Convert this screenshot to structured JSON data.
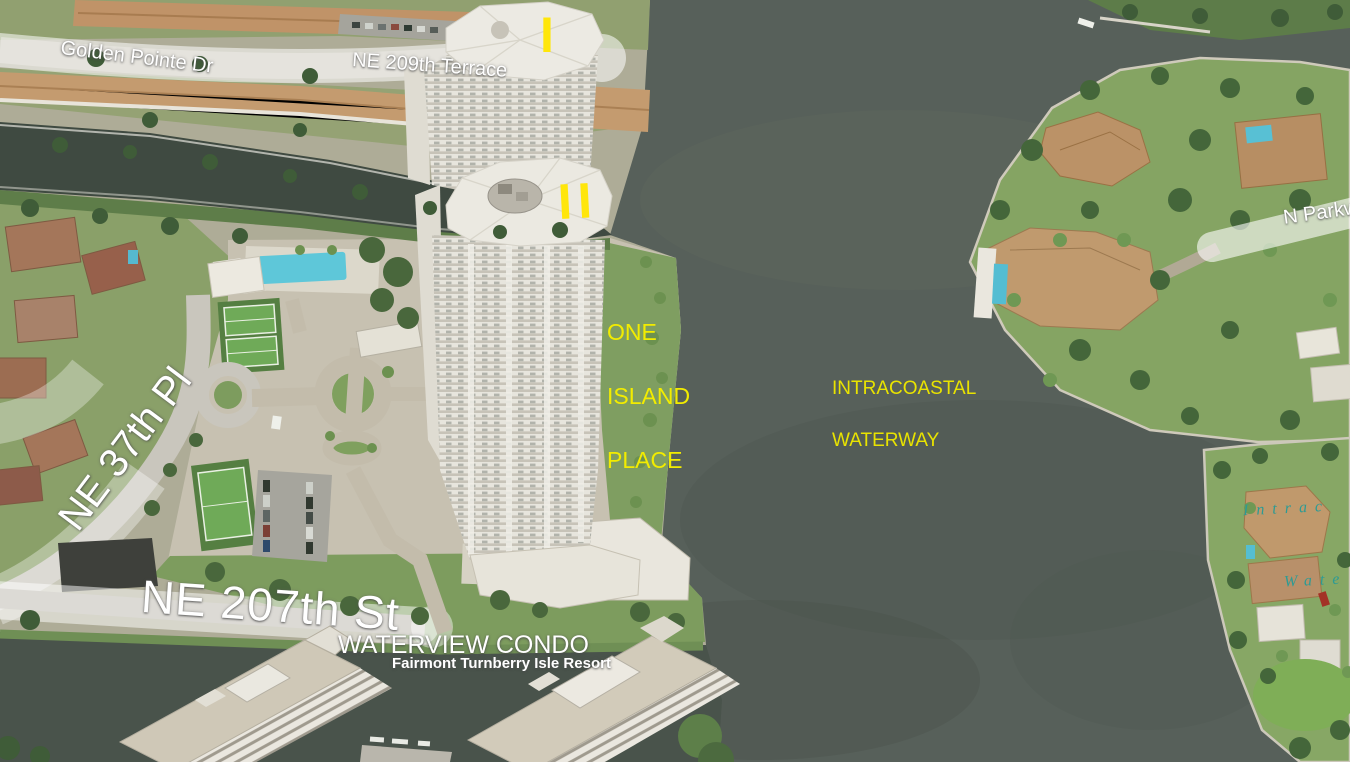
{
  "map": {
    "view": "aerial-birds-eye",
    "street_labels": {
      "golden_pointe": "Golden Pointe Dr",
      "ne_209th_terrace": "NE 209th Terrace",
      "n_parkway": "N Parkw",
      "ne_37th_pl": "NE 37th Pl",
      "ne_207th_st": "NE 207th St"
    },
    "place_labels": {
      "one_island": {
        "line1": "ONE",
        "line2": "ISLAND",
        "line3": "PLACE"
      },
      "intracoastal": {
        "line1": "INTRACOASTAL",
        "line2": "WATERWAY"
      },
      "waterview_condo": "WATERVIEW CONDO",
      "fairmont": "Fairmont Turnberry Isle Resort",
      "tower1_marker": "I",
      "tower2_marker": "II",
      "water_script_1": "Intrac",
      "water_script_2": "Wate"
    },
    "colors": {
      "water_main": "#57605a",
      "water_canal": "#3f4a41",
      "label_yellow": "#f2ec00",
      "marker_yellow": "#ffe60a",
      "water_script_teal": "#2d9b94",
      "street_label_white": "#ffffff",
      "road_band": "rgba(255,255,255,0.55)"
    }
  }
}
